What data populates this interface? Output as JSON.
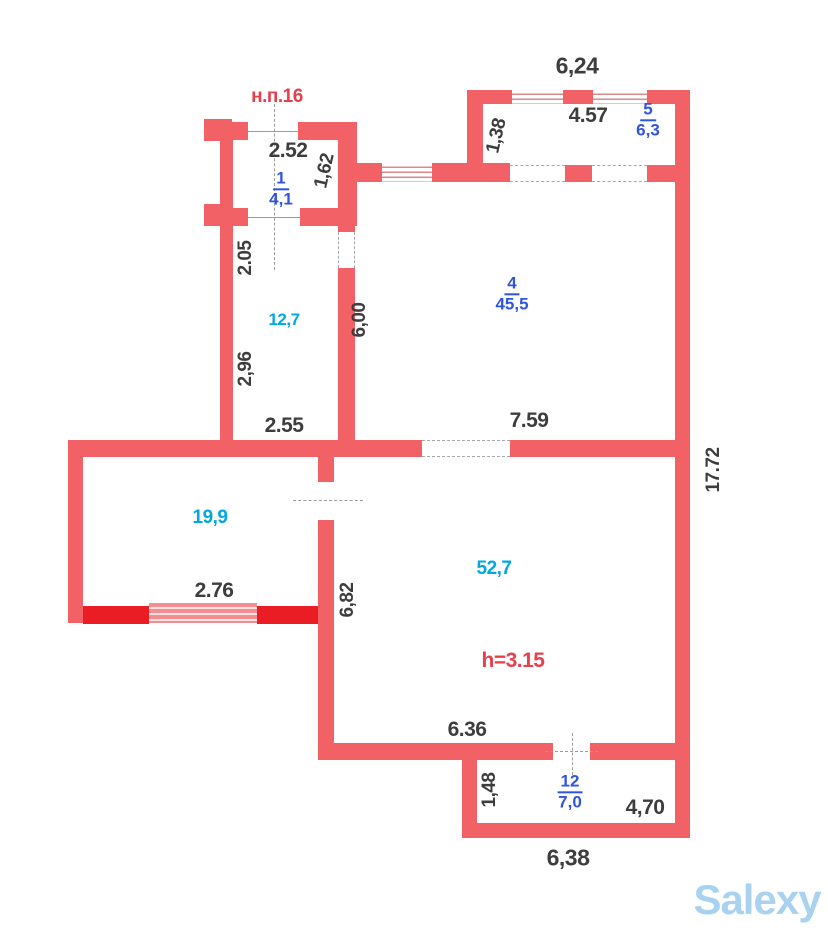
{
  "plan_title": "н.п.16",
  "watermark": "Salexy",
  "colors": {
    "wall": "#f26165",
    "wall-edge": "#e23b41",
    "highlight": "#ea1c24",
    "blue": "#2f55dd",
    "cyan": "#00a8e0",
    "redlbl": "#e6404d",
    "dim": "#3d3d3d",
    "watermark": "#a9d2f0"
  },
  "rooms": {
    "r1": {
      "number": "1",
      "area": "4,1"
    },
    "r5": {
      "number": "5",
      "area": "6,3"
    },
    "r4": {
      "number": "4",
      "area": "45,5"
    },
    "r12": {
      "number": "12",
      "area": "7,0"
    },
    "hall_12_7": {
      "area": "12,7"
    },
    "hall_19_9": {
      "area": "19,9"
    },
    "hall_52_7": {
      "area": "52,7"
    }
  },
  "dimensions": {
    "top_width": "6,24",
    "room5_width": "4.57",
    "room5_depth": "1,38",
    "room1_width": "2.52",
    "room1_depth": "1,62",
    "wall_2_05": "2.05",
    "wall_2_96": "2,96",
    "wall_2_55": "2.55",
    "corridor_6_00": "6,00",
    "room4_width": "7.59",
    "right_height": "17.72",
    "room19_window": "2.76",
    "room52_left": "6,82",
    "room52_width": "6.36",
    "room12_depth": "1,48",
    "room12_right": "4,70",
    "bottom_width": "6,38",
    "ceiling_height": "h=3.15"
  }
}
